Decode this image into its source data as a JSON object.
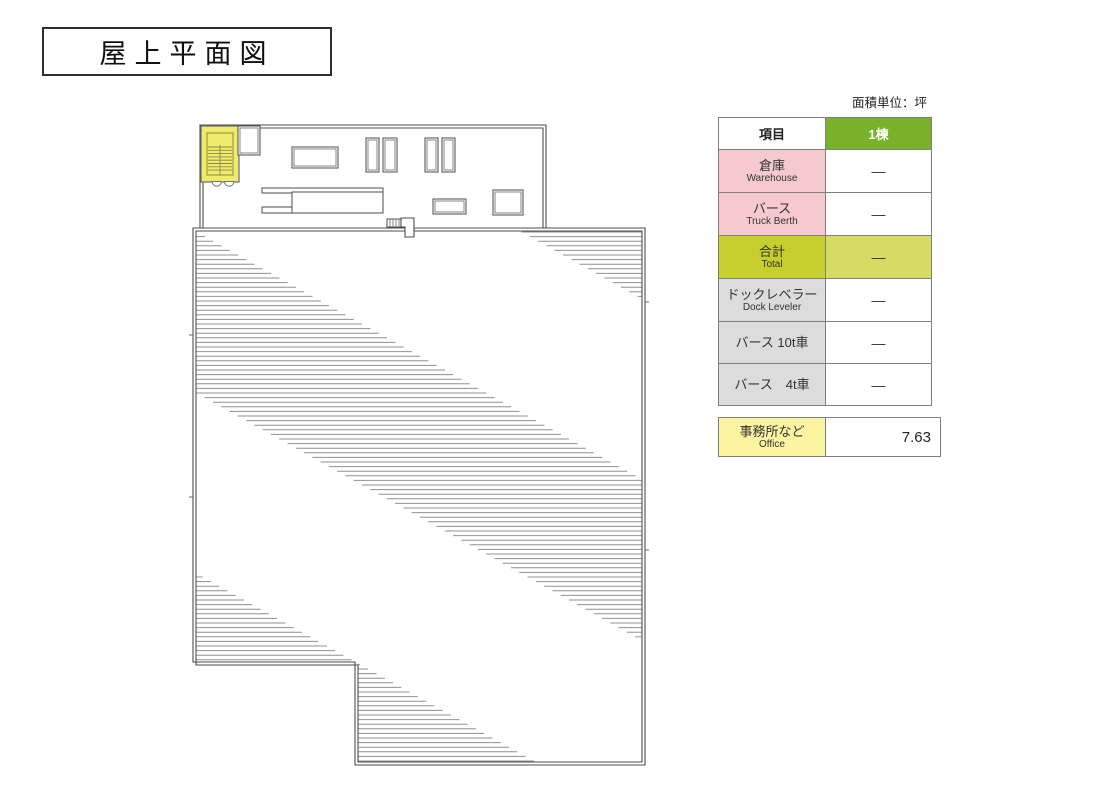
{
  "page": {
    "title": "屋上平面図",
    "unit_note": "面積単位：坪"
  },
  "table": {
    "header": {
      "item": "項目",
      "building": "1棟"
    },
    "rows": [
      {
        "ja": "倉庫",
        "en": "Warehouse",
        "value": "―"
      },
      {
        "ja": "バース",
        "en": "Truck Berth",
        "value": "―"
      },
      {
        "ja": "合計",
        "en": "Total",
        "value": "―"
      },
      {
        "ja": "ドックレベラー",
        "en": "Dock Leveler",
        "value": "―"
      },
      {
        "ja": "バース 10t車",
        "en": "",
        "value": "―"
      },
      {
        "ja": "バース　4t車",
        "en": "",
        "value": "―"
      }
    ],
    "office_row": {
      "ja": "事務所など",
      "en": "Office",
      "value": "7.63"
    }
  },
  "plan": {
    "features": [
      "stairwell",
      "elevator-shaft",
      "roof-vents",
      "roof-equipment",
      "drain-notch",
      "slope-hatch-stripes"
    ]
  },
  "colors": {
    "header_green": "#77B22A",
    "pink": "#F6C9CE",
    "total_label": "#C6CF2D",
    "total_value": "#D6DC63",
    "gray": "#DCDCDC",
    "office_yellow": "#FBF5A1",
    "stairwell_yellow": "#EFEB6F",
    "wall_line": "#4d4d4d",
    "hatch_line": "#909090",
    "table_border": "#7f7f7f"
  }
}
